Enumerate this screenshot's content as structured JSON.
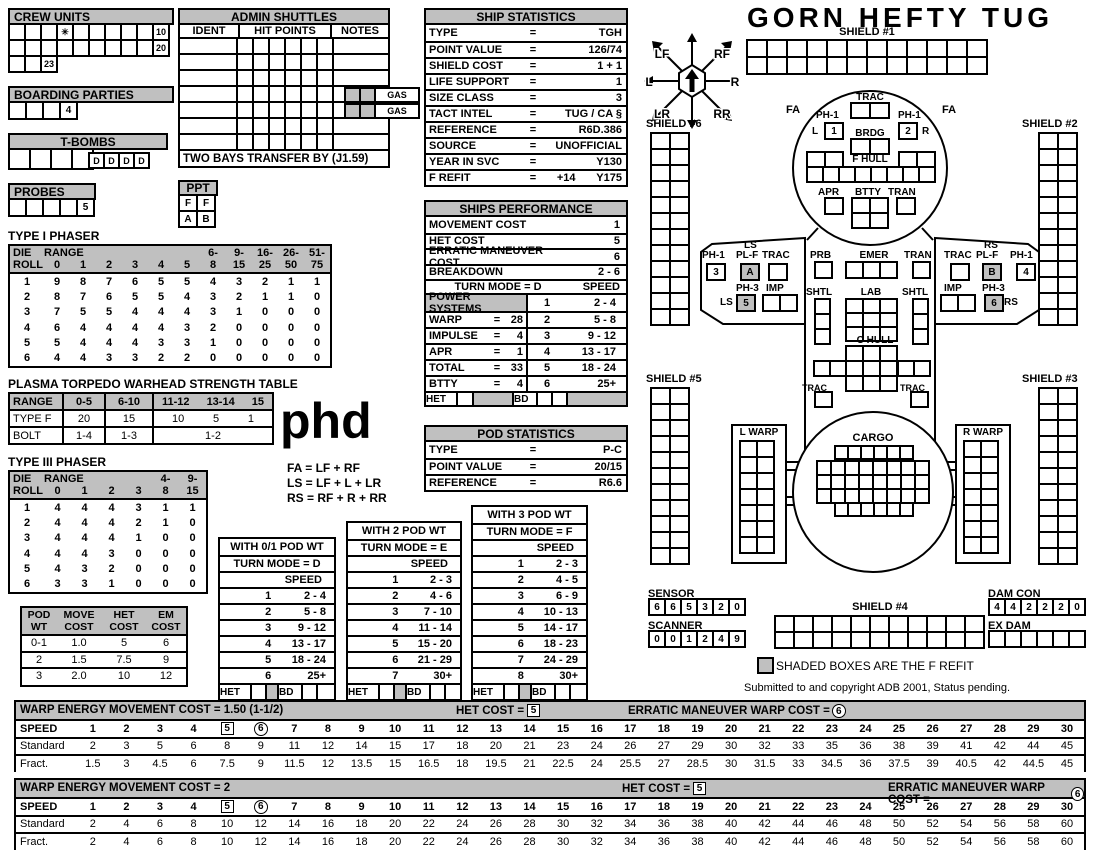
{
  "colors": {
    "shade": "#c0c0c0",
    "line": "#000000"
  },
  "crew_units": {
    "title": "CREW UNITS",
    "row1": [
      "",
      "",
      "",
      "✳",
      "",
      "",
      "",
      "",
      "",
      "10"
    ],
    "row2": [
      "",
      "",
      "",
      "",
      "",
      "",
      "",
      "",
      "",
      "20"
    ],
    "row3": [
      "",
      "",
      "23"
    ]
  },
  "boarding_parties": {
    "title": "BOARDING PARTIES",
    "cells": [
      "",
      "",
      "",
      "4"
    ]
  },
  "t_bombs": {
    "title": "T-BOMBS",
    "cells": [
      "",
      "",
      "",
      ""
    ],
    "d_cells": [
      "D",
      "D",
      "D",
      "D"
    ]
  },
  "probes": {
    "title": "PROBES",
    "cells": [
      "",
      "",
      "",
      "",
      "5"
    ]
  },
  "admin_shuttles": {
    "title": "ADMIN SHUTTLES",
    "cols": [
      "IDENT",
      "HIT POINTS",
      "NOTES"
    ],
    "row_count": 7,
    "hit_cols": 6,
    "gas_rows": [
      3,
      4
    ],
    "gas_label": "GAS",
    "footer": "TWO BAYS TRANSFER BY (J1.59)"
  },
  "ppt": {
    "title": "PPT",
    "cells": [
      "F",
      "F",
      "A",
      "B"
    ]
  },
  "ship_statistics": {
    "title": "SHIP STATISTICS",
    "eq": "=",
    "rows": [
      {
        "label": "TYPE",
        "value": "TGH"
      },
      {
        "label": "POINT VALUE",
        "value": "126/74"
      },
      {
        "label": "SHIELD COST",
        "value": "1 + 1"
      },
      {
        "label": "LIFE SUPPORT",
        "value": "1"
      },
      {
        "label": "SIZE CLASS",
        "value": "3"
      },
      {
        "label": "TACT INTEL",
        "value": "TUG / CA §"
      },
      {
        "label": "REFERENCE",
        "value": "R6D.386"
      },
      {
        "label": "SOURCE",
        "value": "UNOFFICIAL"
      },
      {
        "label": "YEAR IN SVC",
        "value": "Y130"
      },
      {
        "label": "F REFIT",
        "value": "+14",
        "value2": "Y175"
      }
    ]
  },
  "ships_performance": {
    "title": "SHIPS PERFORMANCE",
    "top_rows": [
      {
        "label": "MOVEMENT COST",
        "value": "1"
      },
      {
        "label": "HET COST",
        "value": "5"
      },
      {
        "label": "ERRATIC MANEUVER COST",
        "value": "6"
      },
      {
        "label": "BREAKDOWN",
        "value": "2 - 6"
      }
    ],
    "turn_mode": "TURN MODE = D",
    "speed_label": "SPEED",
    "power_rows": [
      {
        "label": "POWER SYSTEMS",
        "header": true,
        "num": "1",
        "range": "2 - 4"
      },
      {
        "label": "WARP",
        "value": "28",
        "num": "2",
        "range": "5 - 8"
      },
      {
        "label": "IMPULSE",
        "value": "4",
        "num": "3",
        "range": "9 - 12"
      },
      {
        "label": "APR",
        "value": "1",
        "num": "4",
        "range": "13 - 17"
      },
      {
        "label": "TOTAL",
        "value": "33",
        "num": "5",
        "range": "18 - 24"
      },
      {
        "label": "BTTY",
        "value": "4",
        "num": "6",
        "range": "25+"
      }
    ],
    "het_label": "HET",
    "bd_label": "BD"
  },
  "pod_statistics": {
    "title": "POD STATISTICS",
    "eq": "=",
    "rows": [
      {
        "label": "TYPE",
        "value": "P-C"
      },
      {
        "label": "POINT VALUE",
        "value": "20/15"
      },
      {
        "label": "REFERENCE",
        "value": "R6.6"
      }
    ]
  },
  "type1_phaser": {
    "title": "TYPE I PHASER",
    "hdr1": [
      "DIE",
      "RANGE",
      "",
      "",
      "",
      "",
      "",
      "6-",
      "9-",
      "16-",
      "26-",
      "51-"
    ],
    "hdr2": [
      "ROLL",
      "0",
      "1",
      "2",
      "3",
      "4",
      "5",
      "8",
      "15",
      "25",
      "50",
      "75"
    ],
    "rows": [
      [
        "1",
        "9",
        "8",
        "7",
        "6",
        "5",
        "5",
        "4",
        "3",
        "2",
        "1",
        "1"
      ],
      [
        "2",
        "8",
        "7",
        "6",
        "5",
        "5",
        "4",
        "3",
        "2",
        "1",
        "1",
        "0"
      ],
      [
        "3",
        "7",
        "5",
        "5",
        "4",
        "4",
        "4",
        "3",
        "1",
        "0",
        "0",
        "0"
      ],
      [
        "4",
        "6",
        "4",
        "4",
        "4",
        "4",
        "3",
        "2",
        "0",
        "0",
        "0",
        "0"
      ],
      [
        "5",
        "5",
        "4",
        "4",
        "4",
        "3",
        "3",
        "1",
        "0",
        "0",
        "0",
        "0"
      ],
      [
        "6",
        "4",
        "4",
        "3",
        "3",
        "2",
        "2",
        "0",
        "0",
        "0",
        "0",
        "0"
      ]
    ]
  },
  "plasma_table": {
    "title": "PLASMA TORPEDO WARHEAD STRENGTH TABLE",
    "hdr": [
      "RANGE",
      "0-5",
      "6-10"
    ],
    "hdr_wide": [
      "11-12",
      "13-14",
      "15"
    ],
    "type_f": {
      "label": "TYPE F",
      "c1": "20",
      "c2": "15",
      "wide": [
        "10",
        "5",
        "1"
      ]
    },
    "bolt": {
      "label": "BOLT",
      "c1": "1-4",
      "c2": "1-3",
      "wide": "1-2"
    }
  },
  "phd_text": "phd",
  "arc_legend": [
    "FA = LF + RF",
    "LS = LF + L + LR",
    "RS = RF + R + RR"
  ],
  "type3_phaser": {
    "title": "TYPE III PHASER",
    "hdr1": [
      "DIE",
      "RANGE",
      "",
      "",
      "",
      "4-",
      "9-"
    ],
    "hdr2": [
      "ROLL",
      "0",
      "1",
      "2",
      "3",
      "8",
      "15"
    ],
    "rows": [
      [
        "1",
        "4",
        "4",
        "4",
        "3",
        "1",
        "1"
      ],
      [
        "2",
        "4",
        "4",
        "4",
        "2",
        "1",
        "0"
      ],
      [
        "3",
        "4",
        "4",
        "4",
        "1",
        "0",
        "0"
      ],
      [
        "4",
        "4",
        "4",
        "3",
        "0",
        "0",
        "0"
      ],
      [
        "5",
        "4",
        "3",
        "2",
        "0",
        "0",
        "0"
      ],
      [
        "6",
        "3",
        "3",
        "1",
        "0",
        "0",
        "0"
      ]
    ]
  },
  "pod_cost": {
    "hdr": [
      "POD\nWT",
      "MOVE\nCOST",
      "HET\nCOST",
      "EM\nCOST"
    ],
    "rows": [
      [
        "0-1",
        "1.0",
        "5",
        "6"
      ],
      [
        "2",
        "1.5",
        "7.5",
        "9"
      ],
      [
        "3",
        "2.0",
        "10",
        "12"
      ]
    ]
  },
  "pod_wt_tables": [
    {
      "title": "WITH 0/1 POD WT",
      "turn": "TURN MODE = D",
      "speed": "SPEED",
      "het": "HET",
      "bd": "BD",
      "rows": [
        [
          "1",
          "2 - 4"
        ],
        [
          "2",
          "5 - 8"
        ],
        [
          "3",
          "9 - 12"
        ],
        [
          "4",
          "13 - 17"
        ],
        [
          "5",
          "18 - 24"
        ],
        [
          "6",
          "25+"
        ]
      ]
    },
    {
      "title": "WITH 2 POD WT",
      "turn": "TURN MODE = E",
      "speed": "SPEED",
      "het": "HET",
      "bd": "BD",
      "rows": [
        [
          "1",
          "2 - 3"
        ],
        [
          "2",
          "4 - 6"
        ],
        [
          "3",
          "7 - 10"
        ],
        [
          "4",
          "11 - 14"
        ],
        [
          "5",
          "15 - 20"
        ],
        [
          "6",
          "21 - 29"
        ],
        [
          "7",
          "30+"
        ]
      ]
    },
    {
      "title": "WITH 3 POD WT",
      "turn": "TURN MODE = F",
      "speed": "SPEED",
      "het": "HET",
      "bd": "BD",
      "rows": [
        [
          "1",
          "2 - 3"
        ],
        [
          "2",
          "4 - 5"
        ],
        [
          "3",
          "6 - 9"
        ],
        [
          "4",
          "10 - 13"
        ],
        [
          "5",
          "14 - 17"
        ],
        [
          "6",
          "18 - 23"
        ],
        [
          "7",
          "24 - 29"
        ],
        [
          "8",
          "30+"
        ]
      ]
    }
  ],
  "diagram": {
    "title": "GORN HEFTY TUG",
    "compass": {
      "lf": "LF",
      "rf": "RF",
      "l": "L",
      "r": "R",
      "lr": "LR",
      "rr": "RR"
    },
    "shields": {
      "s1": "SHIELD #1",
      "s2": "SHIELD #2",
      "s3": "SHIELD #3",
      "s4": "SHIELD #4",
      "s5": "SHIELD #5",
      "s6": "SHIELD #6"
    },
    "labels": {
      "trac": "TRAC",
      "brdg": "BRDG",
      "fhull": "F HULL",
      "apr": "APR",
      "btty": "BTTY",
      "tran": "TRAN",
      "fa": "FA",
      "ph1": "PH-1",
      "ph3": "PH-3",
      "pl_f": "PL-F",
      "ls": "LS",
      "rs": "RS",
      "imp": "IMP",
      "prb": "PRB",
      "emer": "EMER",
      "shtl": "SHTL",
      "lab": "LAB",
      "chull": "C HULL",
      "cargo": "CARGO",
      "lwarp": "L WARP",
      "rwarp": "R WARP",
      "l": "L",
      "r": "R",
      "sensor": "SENSOR",
      "scanner": "SCANNER",
      "damcon": "DAM CON",
      "exdam": "EX DAM"
    },
    "mounts": {
      "ph1_fl": "1",
      "ph1_fr": "2",
      "ph1_wl": "3",
      "ph1_wr": "4",
      "ph3_l": "5",
      "ph3_r": "6",
      "plf_l": "A",
      "plf_r": "B"
    },
    "sensor": [
      "6",
      "6",
      "5",
      "3",
      "2",
      "0"
    ],
    "scanner": [
      "0",
      "0",
      "1",
      "2",
      "4",
      "9"
    ],
    "damcon": [
      "4",
      "4",
      "2",
      "2",
      "2",
      "0"
    ],
    "exdam_count": 6,
    "refit_note": "SHADED BOXES ARE THE F REFIT",
    "copyright": "Submitted to and copyright ADB 2001, Status pending."
  },
  "warp_tables": [
    {
      "title": "WARP ENERGY MOVEMENT COST = 1.50 (1-1/2)",
      "het_label": "HET COST =",
      "het_value": "5",
      "em_label": "ERRATIC MANEUVER WARP COST =",
      "em_value": "6",
      "speed_label": "SPEED",
      "standard_label": "Standard",
      "fract_label": "Fract.",
      "speeds": [
        "1",
        "2",
        "3",
        "4",
        "5",
        "6",
        "7",
        "8",
        "9",
        "10",
        "11",
        "12",
        "13",
        "14",
        "15",
        "16",
        "17",
        "18",
        "19",
        "20",
        "21",
        "22",
        "23",
        "24",
        "25",
        "26",
        "27",
        "28",
        "29",
        "30"
      ],
      "standard": [
        "2",
        "3",
        "5",
        "6",
        "8",
        "9",
        "11",
        "12",
        "14",
        "15",
        "17",
        "18",
        "20",
        "21",
        "23",
        "24",
        "26",
        "27",
        "29",
        "30",
        "32",
        "33",
        "35",
        "36",
        "38",
        "39",
        "41",
        "42",
        "44",
        "45"
      ],
      "fract": [
        "1.5",
        "3",
        "4.5",
        "6",
        "7.5",
        "9",
        "11.5",
        "12",
        "13.5",
        "15",
        "16.5",
        "18",
        "19.5",
        "21",
        "22.5",
        "24",
        "25.5",
        "27",
        "28.5",
        "30",
        "31.5",
        "33",
        "34.5",
        "36",
        "37.5",
        "39",
        "40.5",
        "42",
        "44.5",
        "45"
      ]
    },
    {
      "title": "WARP ENERGY MOVEMENT COST = 2",
      "het_label": "HET COST =",
      "het_value": "5",
      "em_label": "ERRATIC MANEUVER WARP COST =",
      "em_value": "6",
      "speed_label": "SPEED",
      "standard_label": "Standard",
      "fract_label": "Fract.",
      "speeds": [
        "1",
        "2",
        "3",
        "4",
        "5",
        "6",
        "7",
        "8",
        "9",
        "10",
        "11",
        "12",
        "13",
        "14",
        "15",
        "16",
        "17",
        "18",
        "19",
        "20",
        "21",
        "22",
        "23",
        "24",
        "25",
        "26",
        "27",
        "28",
        "29",
        "30"
      ],
      "standard": [
        "2",
        "4",
        "6",
        "8",
        "10",
        "12",
        "14",
        "16",
        "18",
        "20",
        "22",
        "24",
        "26",
        "28",
        "30",
        "32",
        "34",
        "36",
        "38",
        "40",
        "42",
        "44",
        "46",
        "48",
        "50",
        "52",
        "54",
        "56",
        "58",
        "60"
      ],
      "fract": [
        "2",
        "4",
        "6",
        "8",
        "10",
        "12",
        "14",
        "16",
        "18",
        "20",
        "22",
        "24",
        "26",
        "28",
        "30",
        "32",
        "34",
        "36",
        "38",
        "40",
        "42",
        "44",
        "46",
        "48",
        "50",
        "52",
        "54",
        "56",
        "58",
        "60"
      ]
    }
  ]
}
